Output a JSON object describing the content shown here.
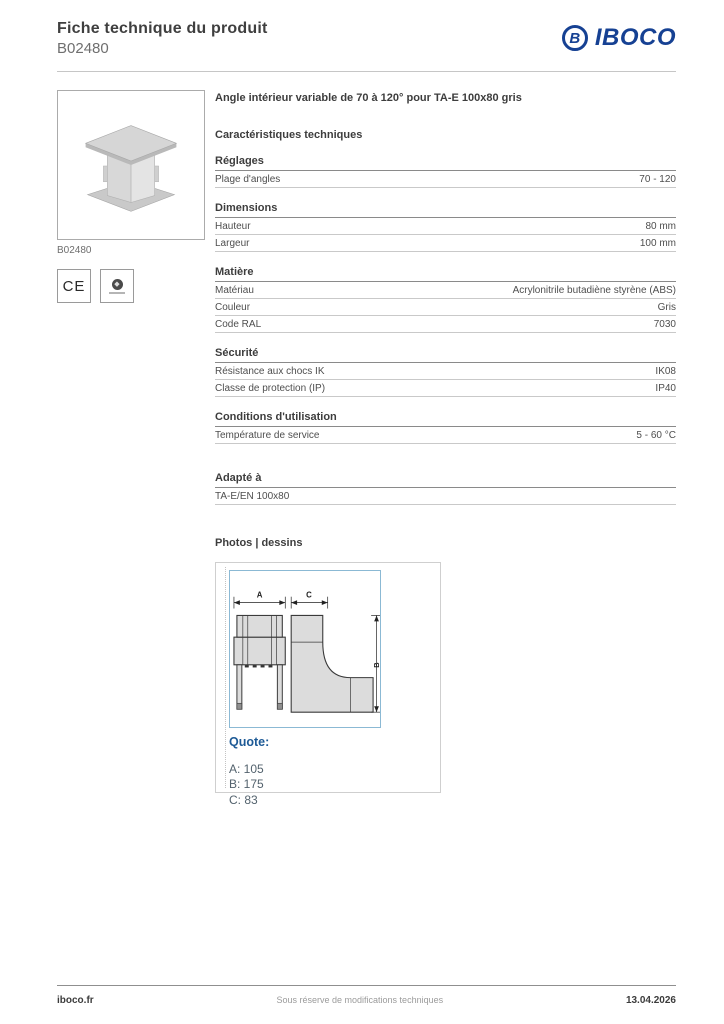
{
  "header": {
    "title": "Fiche technique du produit",
    "product_code": "B02480",
    "brand": "IBOCO",
    "brand_initial": "B"
  },
  "left_panel": {
    "photo_caption": "B02480",
    "ce_mark": "CE"
  },
  "product": {
    "name": "Angle intérieur variable de 70 à 120° pour TA-E 100x80 gris"
  },
  "characteristics_title": "Caractéristiques techniques",
  "spec_sections": [
    {
      "heading": "Réglages",
      "rows": [
        {
          "label": "Plage d'angles",
          "value": "70 - 120"
        }
      ]
    },
    {
      "heading": "Dimensions",
      "rows": [
        {
          "label": "Hauteur",
          "value": "80 mm"
        },
        {
          "label": "Largeur",
          "value": "100 mm"
        }
      ]
    },
    {
      "heading": "Matière",
      "rows": [
        {
          "label": "Matériau",
          "value": "Acrylonitrile butadiène styrène (ABS)"
        },
        {
          "label": "Couleur",
          "value": "Gris"
        },
        {
          "label": "Code RAL",
          "value": "7030"
        }
      ]
    },
    {
      "heading": "Sécurité",
      "rows": [
        {
          "label": "Résistance aux chocs IK",
          "value": "IK08"
        },
        {
          "label": "Classe de protection (IP)",
          "value": "IP40"
        }
      ]
    },
    {
      "heading": "Conditions d'utilisation",
      "rows": [
        {
          "label": "Température de service",
          "value": "5 - 60 °C"
        }
      ]
    }
  ],
  "adapte": {
    "heading": "Adapté à",
    "value": "TA-E/EN 100x80"
  },
  "photos": {
    "heading": "Photos | dessins",
    "quote_label": "Quote:",
    "quote_lines": {
      "a": "A: 105",
      "b": "B: 175",
      "c": "C: 83"
    },
    "drawing_labels": {
      "a": "A",
      "b": "B",
      "c": "C"
    }
  },
  "footer": {
    "left": "iboco.fr",
    "center": "Sous réserve de modifications techniques",
    "right": "13.04.2026"
  },
  "colors": {
    "brand_blue": "#164193",
    "quote_blue": "#1d5a96",
    "drawing_border_blue": "#8bb9d4",
    "product_gray": "#dcdcdc"
  }
}
